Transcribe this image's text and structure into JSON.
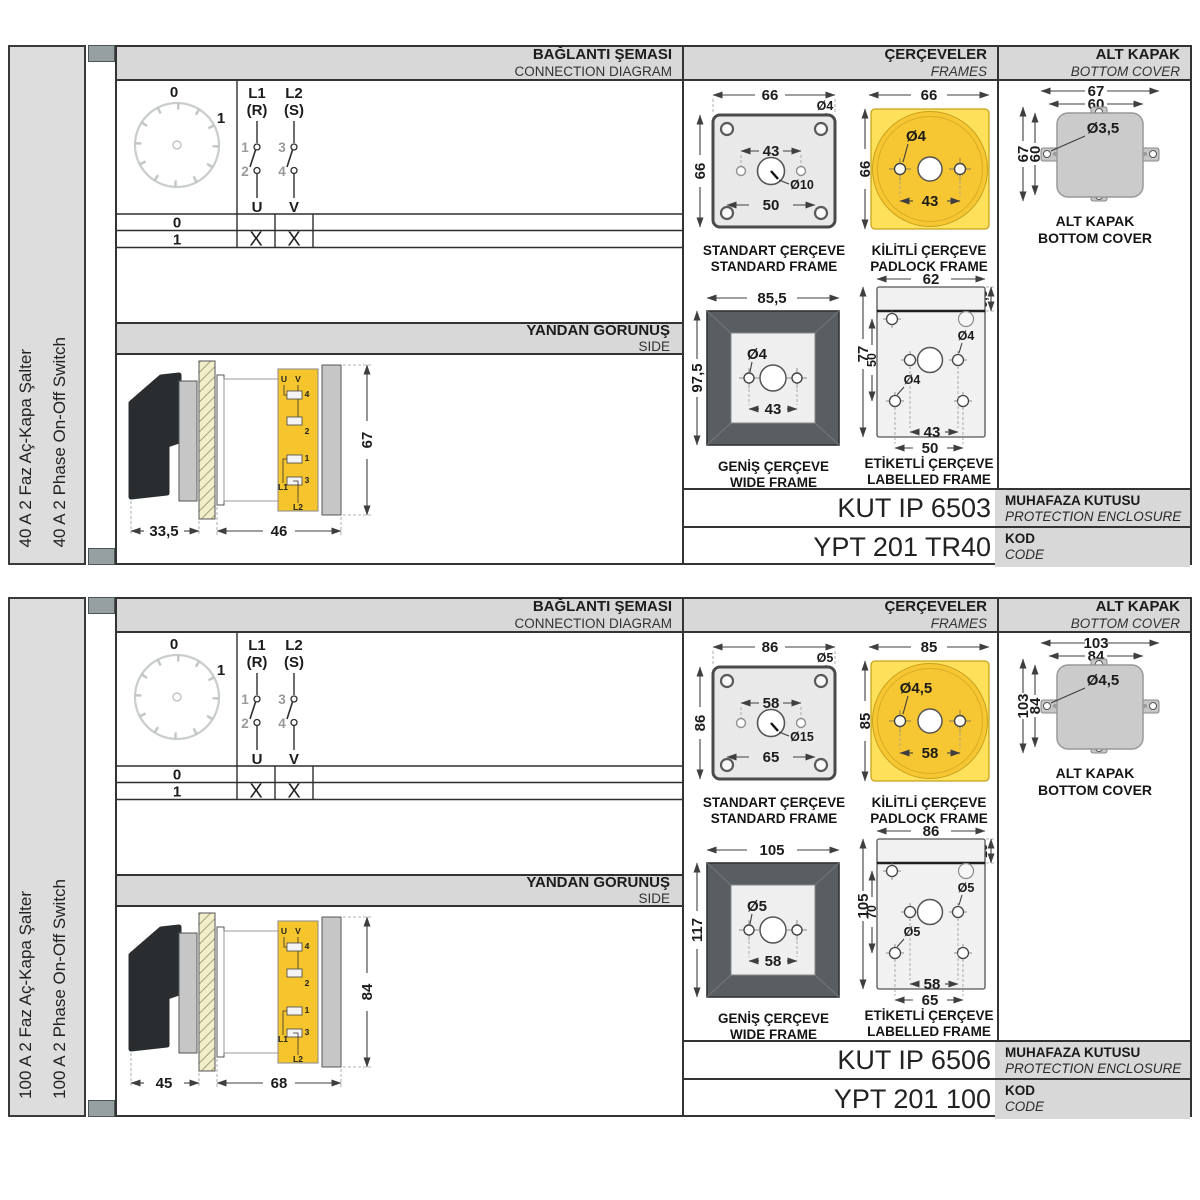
{
  "sections": [
    {
      "sidebar": {
        "title_tr": "40 A 2 Faz Aç-Kapa Şalter",
        "title_en": "40 A 2 Phase On-Off Switch"
      },
      "headers": {
        "connection_tr": "BAĞLANTI ŞEMASI",
        "connection_en": "CONNECTION DIAGRAM",
        "frames_tr": "ÇERÇEVELER",
        "frames_en": "FRAMES",
        "cover_tr": "ALT KAPAK",
        "cover_en": "BOTTOM COVER",
        "side_tr": "YANDAN GÖRÜNÜŞ",
        "side_en": "SIDE"
      },
      "diagram": {
        "dial": {
          "pos0": "0",
          "pos1": "1"
        },
        "poles": [
          {
            "line": "L1",
            "phase": "(R)",
            "t_top": "1",
            "t_bottom": "2",
            "out": "U"
          },
          {
            "line": "L2",
            "phase": "(S)",
            "t_top": "3",
            "t_bottom": "4",
            "out": "V"
          }
        ],
        "table": {
          "rows": [
            {
              "pos": "0",
              "u": "",
              "v": ""
            },
            {
              "pos": "1",
              "u": "X",
              "v": "X"
            }
          ]
        }
      },
      "side_view": {
        "dim_handle": "33,5",
        "dim_body": "46",
        "dim_height": "67",
        "labels": {
          "u": "U",
          "v": "V",
          "n4": "4",
          "n2": "2",
          "n1": "1",
          "n3": "3",
          "l1": "L1",
          "l2": "L2"
        }
      },
      "frames": {
        "standard": {
          "w": "66",
          "h": "66",
          "hole": "Ø4",
          "inner": "43",
          "center": "Ø10",
          "bottom": "50",
          "cap_tr": "STANDART ÇERÇEVE",
          "cap_en": "STANDARD FRAME"
        },
        "padlock": {
          "w": "66",
          "h": "66",
          "hole": "Ø4",
          "inner": "43",
          "cap_tr": "KİLİTLİ ÇERÇEVE",
          "cap_en": "PADLOCK FRAME"
        },
        "wide": {
          "w": "85,5",
          "h": "97,5",
          "hole": "Ø4",
          "inner": "43",
          "cap_tr": "GENİŞ ÇERÇEVE",
          "cap_en": "WIDE FRAME"
        },
        "labelled": {
          "w": "62",
          "label_h": "9,5",
          "h": "77",
          "inner_span": "50",
          "hole1": "Ø4",
          "hole2": "Ø4",
          "dim1": "43",
          "dim2": "50",
          "cap_tr": "ETİKETLİ ÇERÇEVE",
          "cap_en": "LABELLED FRAME"
        }
      },
      "cover": {
        "w1": "67",
        "w2": "60",
        "h1": "67",
        "h2": "60",
        "hole": "Ø3,5",
        "cap_tr": "ALT KAPAK",
        "cap_en": "BOTTOM COVER"
      },
      "codes": {
        "enclosure_value": "KUT IP 6503",
        "enclosure_tr": "MUHAFAZA KUTUSU",
        "enclosure_en": "PROTECTION ENCLOSURE",
        "code_value": "YPT 201 TR40",
        "code_tr": "KOD",
        "code_en": "CODE"
      }
    },
    {
      "sidebar": {
        "title_tr": "100 A 2 Faz Aç-Kapa Şalter",
        "title_en": "100 A 2 Phase On-Off Switch"
      },
      "headers": {
        "connection_tr": "BAĞLANTI ŞEMASI",
        "connection_en": "CONNECTION DIAGRAM",
        "frames_tr": "ÇERÇEVELER",
        "frames_en": "FRAMES",
        "cover_tr": "ALT KAPAK",
        "cover_en": "BOTTOM COVER",
        "side_tr": "YANDAN GÖRÜNÜŞ",
        "side_en": "SIDE"
      },
      "diagram": {
        "dial": {
          "pos0": "0",
          "pos1": "1"
        },
        "poles": [
          {
            "line": "L1",
            "phase": "(R)",
            "t_top": "1",
            "t_bottom": "2",
            "out": "U"
          },
          {
            "line": "L2",
            "phase": "(S)",
            "t_top": "3",
            "t_bottom": "4",
            "out": "V"
          }
        ],
        "table": {
          "rows": [
            {
              "pos": "0",
              "u": "",
              "v": ""
            },
            {
              "pos": "1",
              "u": "X",
              "v": "X"
            }
          ]
        }
      },
      "side_view": {
        "dim_handle": "45",
        "dim_body": "68",
        "dim_height": "84",
        "labels": {
          "u": "U",
          "v": "V",
          "n4": "4",
          "n2": "2",
          "n1": "1",
          "n3": "3",
          "l1": "L1",
          "l2": "L2"
        }
      },
      "frames": {
        "standard": {
          "w": "86",
          "h": "86",
          "hole": "Ø5",
          "inner": "58",
          "center": "Ø15",
          "bottom": "65",
          "cap_tr": "STANDART ÇERÇEVE",
          "cap_en": "STANDARD FRAME"
        },
        "padlock": {
          "w": "85",
          "h": "85",
          "hole": "Ø4,5",
          "inner": "58",
          "cap_tr": "KİLİTLİ ÇERÇEVE",
          "cap_en": "PADLOCK FRAME"
        },
        "wide": {
          "w": "105",
          "h": "117",
          "hole": "Ø5",
          "inner": "58",
          "cap_tr": "GENİŞ ÇERÇEVE",
          "cap_en": "WIDE FRAME"
        },
        "labelled": {
          "w": "86",
          "label_h": "13",
          "h": "105",
          "inner_span": "70",
          "hole1": "Ø5",
          "hole2": "Ø5",
          "dim1": "58",
          "dim2": "65",
          "cap_tr": "ETİKETLİ ÇERÇEVE",
          "cap_en": "LABELLED FRAME"
        }
      },
      "cover": {
        "w1": "103",
        "w2": "84",
        "h1": "103",
        "h2": "84",
        "hole": "Ø4,5",
        "cap_tr": "ALT KAPAK",
        "cap_en": "BOTTOM COVER"
      },
      "codes": {
        "enclosure_value": "KUT IP 6506",
        "enclosure_tr": "MUHAFAZA KUTUSU",
        "enclosure_en": "PROTECTION ENCLOSURE",
        "code_value": "YPT 201 100",
        "code_tr": "KOD",
        "code_en": "CODE"
      }
    }
  ]
}
